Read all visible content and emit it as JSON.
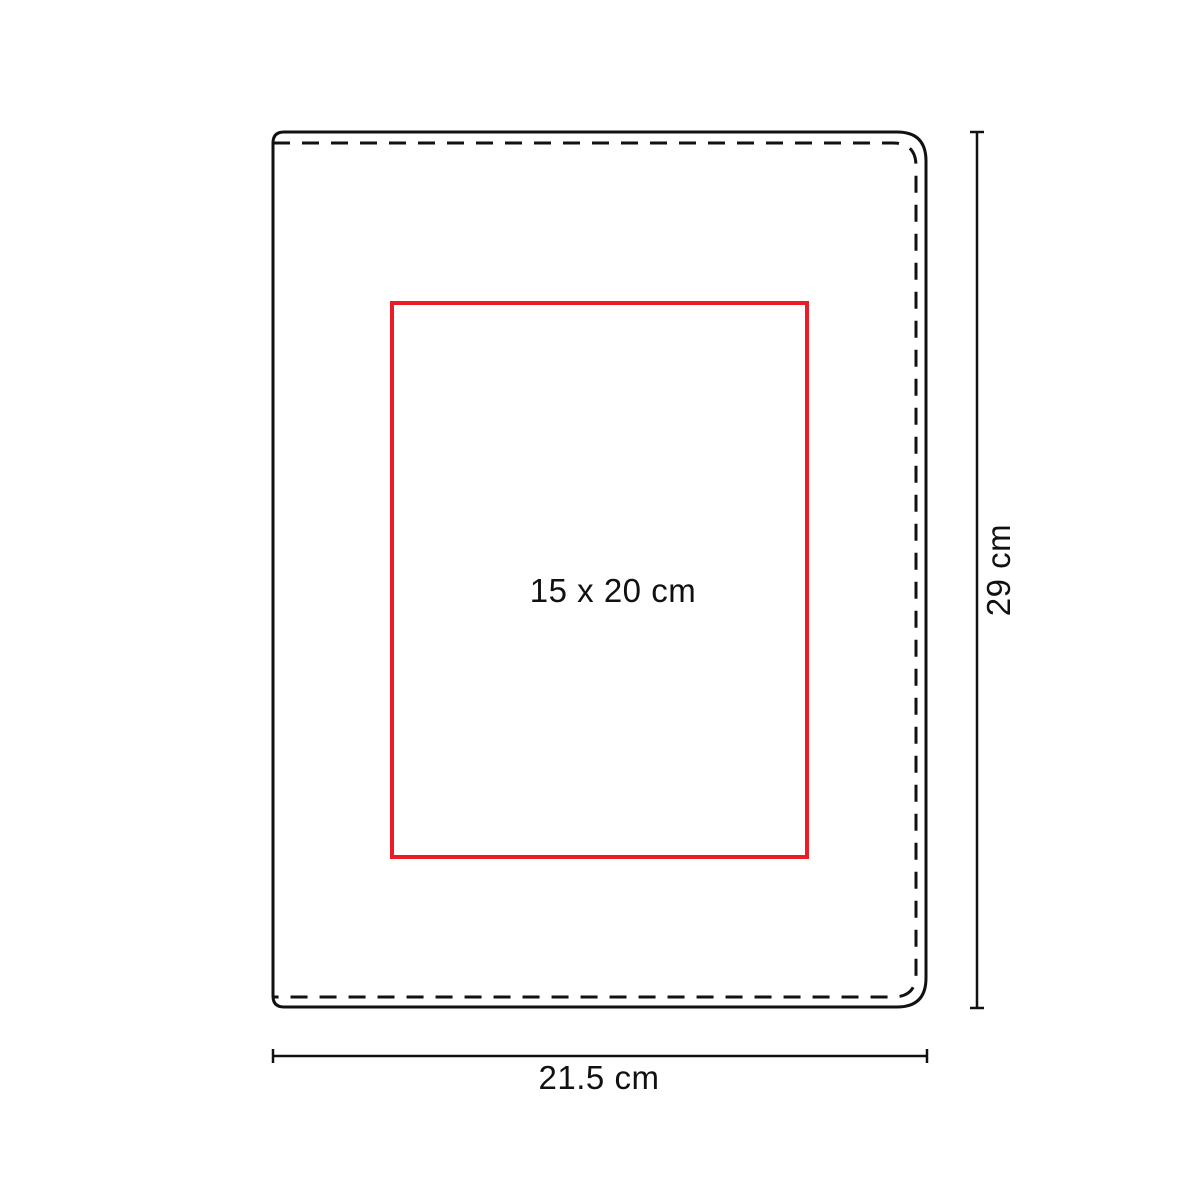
{
  "diagram": {
    "print_area_label": "15 x 20 cm",
    "width_dimension_label": "21.5 cm",
    "height_dimension_label": "29 cm",
    "colors": {
      "print_area_accent": "#ed1c24",
      "line_color": "#111111"
    }
  }
}
